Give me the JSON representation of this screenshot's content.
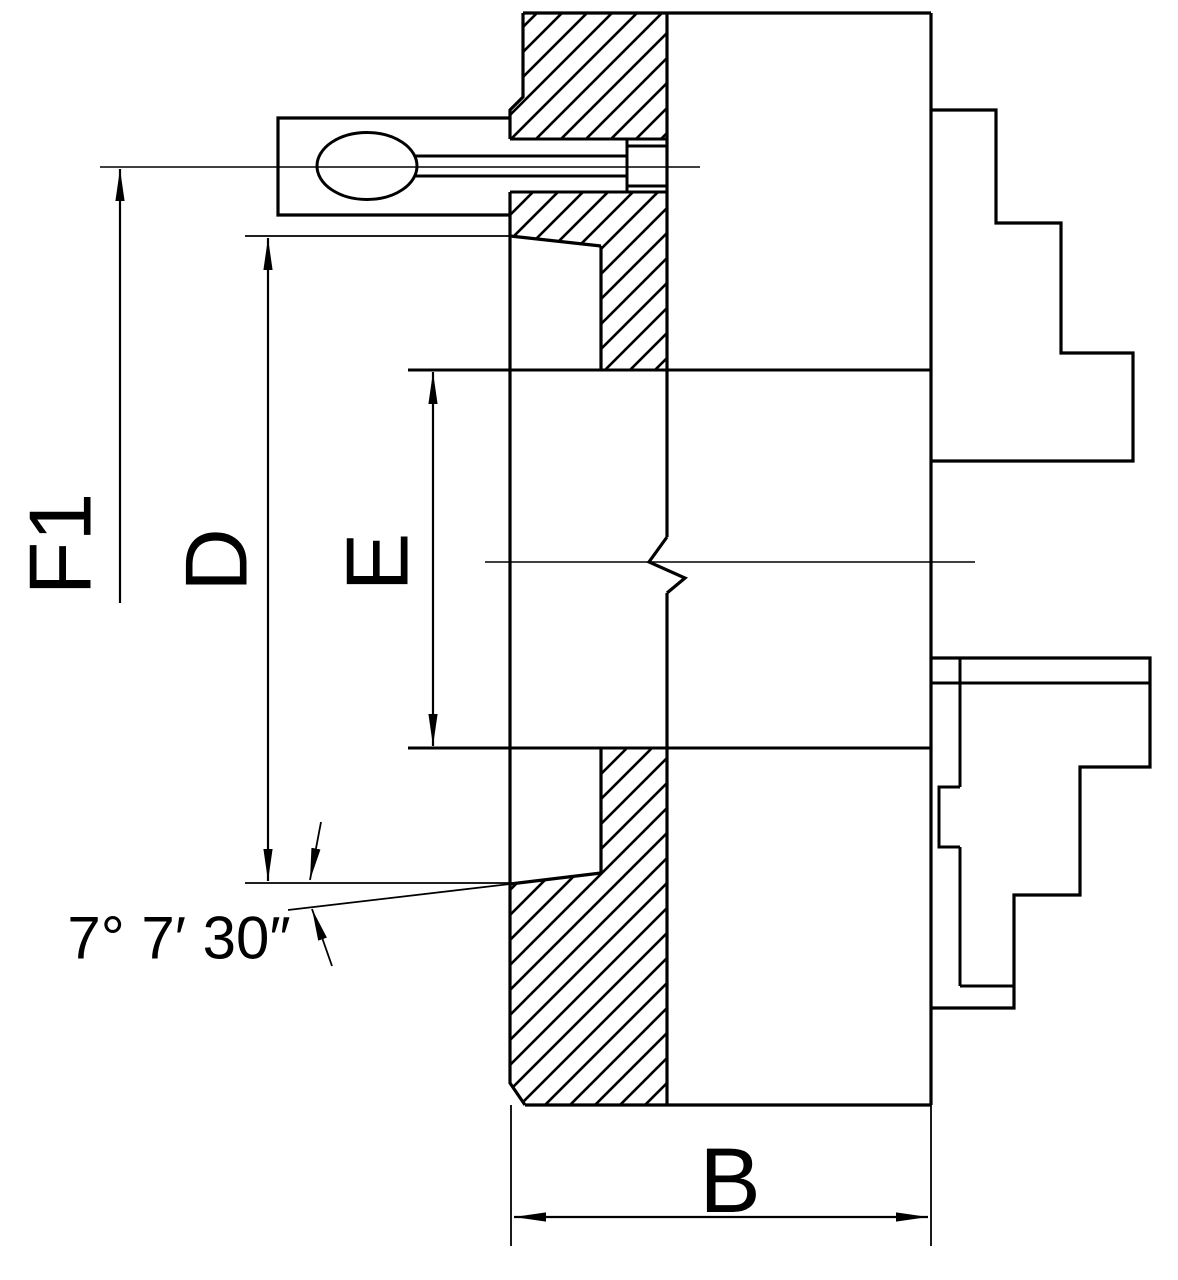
{
  "drawing": {
    "kind": "technical-drawing",
    "subject": "lathe chuck side cross-section with stepped jaws",
    "colors": {
      "line": "#000000",
      "background": "#ffffff"
    }
  },
  "labels": {
    "f1": "F1",
    "d": "D",
    "e": "E",
    "b": "B",
    "taper_angle": "7° 7′ 30″"
  }
}
